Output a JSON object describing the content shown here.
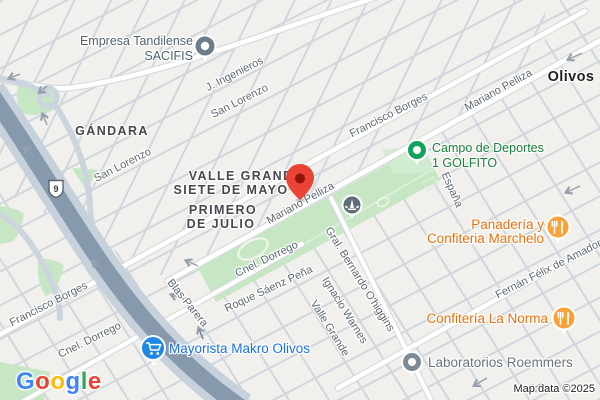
{
  "route_shield": "9",
  "city_label": "Olivos",
  "neighborhoods": {
    "gandara": "GÁNDARA",
    "valle_grande": "VALLE GRANDE",
    "siete_de_mayo": "SIETE DE MAYO",
    "primero_line1": "PRIMERO",
    "primero_line2": "DE JULIO"
  },
  "streets": {
    "j_ingenieros": "J. Ingenieros",
    "san_lorenzo_a": "San Lorenzo",
    "san_lorenzo_b": "San Lorenzo",
    "francisco_borges_a": "Francisco Borges",
    "francisco_borges_b": "Francisco Borges",
    "mariano_pelliza_a": "Mariano Pelliza",
    "mariano_pelliza_b": "Mariano Pelliza",
    "cnel_dorrego_a": "Cnel. Dorrego",
    "cnel_dorrego_b": "Cnel. Dorrego",
    "roque_saenz_pena": "Roque Sáenz Peña",
    "blas_parera": "Blas Parera",
    "gral_bernardo_ohiggins": "Gral. Bernardo O'higgins",
    "ignacio_warnes": "Ignacio Warnes",
    "valle_grande_st": "Valle Grande",
    "espana": "España",
    "fernan_felix": "Fernán Félix de Amador"
  },
  "pois": {
    "empresa": {
      "line1": "Empresa Tandilense",
      "line2": "SACIFIS"
    },
    "campo": {
      "line1": "Campo de Deportes",
      "line2": "1 GOLFITO"
    },
    "panaderia": {
      "line1": "Panadería y",
      "line2": "Confiteria Marchelo"
    },
    "la_norma": {
      "label": "Confitería La Norma"
    },
    "makro": {
      "label": "Mayorista Makro Olivos"
    },
    "roemmers": {
      "label": "Laboratorios Roemmers"
    }
  },
  "logo": [
    "G",
    "o",
    "o",
    "g",
    "l",
    "e"
  ],
  "attribution": "Map data ©2025",
  "colors": {
    "destination_pin": "#EA4335",
    "food_pin": "#F7A23B",
    "food_text": "#E8710A",
    "store_pin": "#1E88E5",
    "store_text": "#1A73E8",
    "park_pin": "#10A35C",
    "park_text": "#188038",
    "park_fill": "#C7E7C4",
    "highway": "#8799AD",
    "generic_pin": "#6C7E8C"
  }
}
